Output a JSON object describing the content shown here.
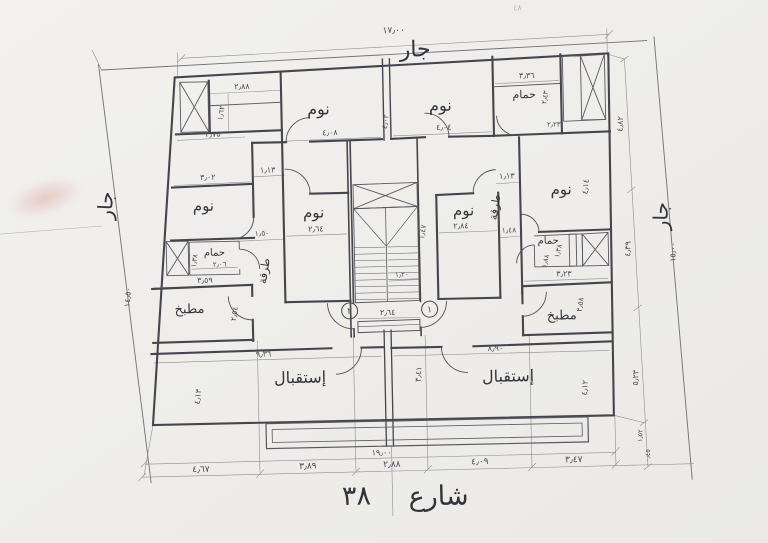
{
  "colors": {
    "paper": "#f0efec",
    "ink": "#45454d",
    "dim_ink": "#8e8e96",
    "smudge": "#d2786e"
  },
  "plan": {
    "drawing_type_labels": {
      "neighbor_top": "جار",
      "neighbor_left": "جار",
      "neighbor_right": "جار",
      "street_name": "شارع",
      "street_number": "٣٨"
    },
    "annotations": [
      {
        "n": "dim-total-top",
        "t": "١٧٫٠٠",
        "x": 399,
        "y": 33,
        "s": 9
      },
      {
        "n": "neighbor-label-top",
        "t": "جار",
        "x": 420,
        "y": 57,
        "s": 22,
        "f": "hand"
      },
      {
        "n": "neighbor-label-left",
        "t": "جار",
        "x": 114,
        "y": 200,
        "s": 20,
        "f": "hand",
        "r": -86
      },
      {
        "n": "dim-left-boundary",
        "t": "١٤٫٥٠",
        "x": 130,
        "y": 292,
        "s": 8,
        "r": -84
      },
      {
        "n": "neighbor-label-right",
        "t": "جار",
        "x": 669,
        "y": 222,
        "s": 20,
        "f": "hand",
        "r": -88
      },
      {
        "n": "dim-right-boundary",
        "t": "١٥٫٠٠",
        "x": 676,
        "y": 258,
        "s": 8,
        "r": -88
      },
      {
        "n": "dim-right-1",
        "t": "٤٫٨٢",
        "x": 626,
        "y": 129,
        "s": 8,
        "r": -87
      },
      {
        "n": "dim-right-2",
        "t": "٤٫٣٩",
        "x": 631,
        "y": 254,
        "s": 8,
        "r": -87
      },
      {
        "n": "dim-right-3",
        "t": "٥٫٢٣",
        "x": 636,
        "y": 383,
        "s": 8,
        "r": -87
      },
      {
        "n": "dim-right-4",
        "t": "١٫٥٢",
        "x": 639,
        "y": 441,
        "s": 6.5,
        "r": -87
      },
      {
        "n": "dim-right-5",
        "t": "٠٫٤٥",
        "x": 646,
        "y": 461,
        "s": 6.5,
        "r": -87
      },
      {
        "n": "dim-bottom-1",
        "t": "٤٫٦٧",
        "x": 197,
        "y": 468,
        "s": 9
      },
      {
        "n": "dim-bottom-2",
        "t": "٣٫٨٩",
        "x": 304,
        "y": 467,
        "s": 9
      },
      {
        "n": "dim-bottom-3",
        "t": "٢٫٨٨",
        "x": 388,
        "y": 467,
        "s": 9
      },
      {
        "n": "dim-bottom-4",
        "t": "٤٫٠٩",
        "x": 476,
        "y": 466,
        "s": 9
      },
      {
        "n": "dim-bottom-5",
        "t": "٣٫٤٧",
        "x": 570,
        "y": 466,
        "s": 9
      },
      {
        "n": "dim-total-bottom",
        "t": "١٩٫٠٠",
        "x": 378,
        "y": 455,
        "s": 8
      },
      {
        "n": "street-label-name",
        "t": "شارع",
        "x": 434,
        "y": 506,
        "s": 27,
        "f": "hand"
      },
      {
        "n": "street-label-number",
        "t": "٣٨",
        "x": 352,
        "y": 504,
        "s": 27,
        "f": "hand"
      },
      {
        "n": "dim-dressing-width",
        "t": "٢٫٨٨",
        "x": 246,
        "y": 86,
        "s": 8
      },
      {
        "n": "dim-dressing-depth",
        "t": "١٫٦٢",
        "x": 227,
        "y": 110,
        "s": 7.5,
        "r": -80
      },
      {
        "n": "dim-closet",
        "t": "٢٫٧٥",
        "x": 216,
        "y": 133,
        "s": 8
      },
      {
        "n": "room-label-bedroom-top-left",
        "t": "نوم",
        "x": 322,
        "y": 113,
        "s": 16,
        "f": "hand"
      },
      {
        "n": "dim-bedroom-top-left",
        "t": "٤٫٠٨",
        "x": 333,
        "y": 134,
        "s": 8
      },
      {
        "n": "dim-center-wall",
        "t": "٤٫٠٢",
        "x": 391,
        "y": 122,
        "s": 7.5,
        "r": -82
      },
      {
        "n": "dim-hall-left",
        "t": "١٫١٣",
        "x": 270,
        "y": 170,
        "s": 8
      },
      {
        "n": "dim-bedroom-left-width",
        "t": "٣٫٠٢",
        "x": 210,
        "y": 176,
        "s": 8
      },
      {
        "n": "room-label-bedroom-left",
        "t": "نوم",
        "x": 205,
        "y": 207,
        "s": 15,
        "f": "hand"
      },
      {
        "n": "room-label-bedroom-mid-left",
        "t": "نوم",
        "x": 315,
        "y": 216,
        "s": 15,
        "f": "hand"
      },
      {
        "n": "dim-bedroom-mid-left",
        "t": "٢٫٦٤",
        "x": 317,
        "y": 230,
        "s": 8
      },
      {
        "n": "dim-corridor-left",
        "t": "١٫٥٠",
        "x": 263,
        "y": 233,
        "s": 7.5
      },
      {
        "n": "room-label-bath-left",
        "t": "حمام",
        "x": 215,
        "y": 252,
        "s": 10,
        "f": "hand"
      },
      {
        "n": "dim-bath-left",
        "t": "٢٫٠٦",
        "x": 220,
        "y": 263,
        "s": 7
      },
      {
        "n": "dim-bath-left-depth",
        "t": "١٫٣٨",
        "x": 197,
        "y": 257,
        "s": 7,
        "r": -80
      },
      {
        "n": "hall-label-left",
        "t": "طرقة",
        "x": 268,
        "y": 269,
        "s": 11,
        "f": "hand",
        "r": -80
      },
      {
        "n": "room-label-kitchen-left",
        "t": "مطبخ",
        "x": 189,
        "y": 309,
        "s": 13,
        "f": "hand"
      },
      {
        "n": "dim-kitchen-left-width",
        "t": "٣٫٥٩",
        "x": 205,
        "y": 279,
        "s": 8
      },
      {
        "n": "dim-kitchen-left-depth",
        "t": "٢٫٥٤",
        "x": 236,
        "y": 311,
        "s": 7.5,
        "r": -80
      },
      {
        "n": "room-label-reception-left",
        "t": "إستقبال",
        "x": 298,
        "y": 381,
        "s": 16,
        "f": "hand"
      },
      {
        "n": "dim-reception-left-width",
        "t": "٩٫٣٦",
        "x": 262,
        "y": 354,
        "s": 8
      },
      {
        "n": "dim-reception-left-depth",
        "t": "٤٫١٣",
        "x": 198,
        "y": 393,
        "s": 8,
        "r": -82
      },
      {
        "n": "dim-reception-center",
        "t": "٣٫٤١",
        "x": 419,
        "y": 375,
        "s": 8,
        "r": -85
      },
      {
        "n": "dim-stair-flight",
        "t": "١٫٢٠",
        "x": 402,
        "y": 277,
        "s": 7
      },
      {
        "n": "dim-entry-width",
        "t": "٢٫٦٤",
        "x": 387,
        "y": 315,
        "s": 8
      },
      {
        "n": "unit-number-2",
        "t": "٢",
        "x": 349,
        "y": 313,
        "s": 9,
        "circle": true
      },
      {
        "n": "unit-number-1",
        "t": "١",
        "x": 429,
        "y": 313,
        "s": 9,
        "circle": true
      },
      {
        "n": "room-label-bedroom-top-right",
        "t": "نوم",
        "x": 444,
        "y": 112,
        "s": 16,
        "f": "hand"
      },
      {
        "n": "dim-bedroom-top-right",
        "t": "٤٫٠٤",
        "x": 447,
        "y": 131,
        "s": 8
      },
      {
        "n": "room-label-bath-top-right",
        "t": "حمام",
        "x": 528,
        "y": 101,
        "s": 11,
        "f": "hand"
      },
      {
        "n": "dim-bath-top-right",
        "t": "٣٫٣٦",
        "x": 531,
        "y": 81,
        "s": 8
      },
      {
        "n": "dim-bath-top-right-depth",
        "t": "٢٫٤٣",
        "x": 551,
        "y": 101,
        "s": 7,
        "r": -80
      },
      {
        "n": "dim-shaft-top-right",
        "t": "٢٫٢٣",
        "x": 557,
        "y": 130,
        "s": 7
      },
      {
        "n": "dim-hall-right",
        "t": "١٫١٣",
        "x": 509,
        "y": 181,
        "s": 8
      },
      {
        "n": "hall-label-right",
        "t": "طرقة",
        "x": 500,
        "y": 210,
        "s": 11,
        "f": "hand",
        "r": -80
      },
      {
        "n": "room-label-bedroom-mid-right",
        "t": "نوم",
        "x": 465,
        "y": 217,
        "s": 15,
        "f": "hand"
      },
      {
        "n": "dim-bedroom-mid-right",
        "t": "٢٫٨٤",
        "x": 462,
        "y": 230,
        "s": 8
      },
      {
        "n": "dim-corridor-right",
        "t": "١٫٤٧",
        "x": 426,
        "y": 233,
        "s": 7.5,
        "r": -80
      },
      {
        "n": "dim-bath-hall-right",
        "t": "١٫٤٨",
        "x": 510,
        "y": 235,
        "s": 7.5
      },
      {
        "n": "room-label-bedroom-right",
        "t": "نوم",
        "x": 563,
        "y": 198,
        "s": 15,
        "f": "hand"
      },
      {
        "n": "dim-bedroom-right-depth",
        "t": "٤٫١٤",
        "x": 590,
        "y": 191,
        "s": 8,
        "r": -84
      },
      {
        "n": "room-label-bath-right",
        "t": "حمام",
        "x": 549,
        "y": 247,
        "s": 10,
        "f": "hand"
      },
      {
        "n": "dim-bath-right",
        "t": "١٫٨٨",
        "x": 548,
        "y": 265,
        "s": 7,
        "r": -76
      },
      {
        "n": "dim-bath-right-depth",
        "t": "١٫٣٨",
        "x": 561,
        "y": 255,
        "s": 7,
        "r": -76
      },
      {
        "n": "room-label-kitchen-right",
        "t": "مطبخ",
        "x": 561,
        "y": 323,
        "s": 13,
        "f": "hand"
      },
      {
        "n": "dim-kitchen-right-width",
        "t": "٣٫٢٣",
        "x": 564,
        "y": 280,
        "s": 8
      },
      {
        "n": "dim-kitchen-right-depth",
        "t": "٢٫٥٨",
        "x": 582,
        "y": 309,
        "s": 7.5,
        "r": -80
      },
      {
        "n": "room-label-reception-right",
        "t": "إستقبال",
        "x": 506,
        "y": 384,
        "s": 16,
        "f": "hand"
      },
      {
        "n": "dim-reception-right-width",
        "t": "٨٫٩٠",
        "x": 494,
        "y": 353,
        "s": 8
      },
      {
        "n": "dim-reception-right-depth",
        "t": "٤٫١٢",
        "x": 585,
        "y": 392,
        "s": 8,
        "r": -85
      },
      {
        "n": "scan-mark-top",
        "t": "٤٨",
        "x": 523,
        "y": 13,
        "s": 8,
        "cls": "faint"
      }
    ]
  }
}
